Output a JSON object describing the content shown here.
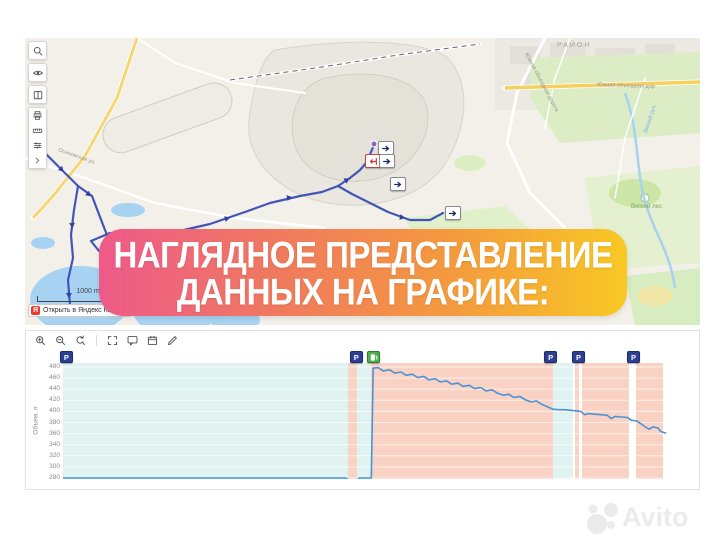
{
  "banner": {
    "line1": "НАГЛЯДНОЕ ПРЕДСТАВЛЕНИЕ",
    "line2": "ДАННЫХ НА ГРАФИКЕ:",
    "gradient": [
      "#ee5a8a",
      "#f0795f",
      "#f49a3e",
      "#f8c824"
    ]
  },
  "map": {
    "scale_label": "1000 m",
    "attribution": "Открыть в Яндекс Картах",
    "attribution_logo_letter": "Я",
    "toolbar_icons": [
      "search",
      "eye",
      "book",
      "print",
      "ruler",
      "tune",
      "chevron-right"
    ],
    "route_color": "#4155b8",
    "labels": [
      {
        "text": "РАЙОН",
        "x": 532,
        "y": 9,
        "size": 7,
        "color": "#a5a39d",
        "rotate": 0,
        "spacing": 2
      },
      {
        "text": "Южная объездная дорога",
        "x": 500,
        "y": 16,
        "size": 5.5,
        "color": "#96948e",
        "rotate": 62,
        "spacing": 0
      },
      {
        "text": "Южная объездная дор",
        "x": 572,
        "y": 48,
        "size": 5.5,
        "color": "#96948e",
        "rotate": 2,
        "spacing": 0
      },
      {
        "text": "Вяский лес",
        "x": 606,
        "y": 170,
        "size": 6,
        "color": "#7aa55a",
        "rotate": 0,
        "spacing": 0
      },
      {
        "text": "Вяский руч.",
        "x": 622,
        "y": 95,
        "size": 5.5,
        "color": "#7fb3de",
        "rotate": -72,
        "spacing": 0
      },
      {
        "text": "Осиновская ул.",
        "x": 33,
        "y": 113,
        "size": 5.5,
        "color": "#9c9a92",
        "rotate": 20,
        "spacing": 0
      }
    ],
    "markers": [
      {
        "x": 353,
        "y": 103,
        "type": "direction"
      },
      {
        "x": 340,
        "y": 116,
        "type": "stop"
      },
      {
        "x": 354,
        "y": 116,
        "type": "direction"
      },
      {
        "x": 365,
        "y": 139,
        "type": "direction"
      },
      {
        "x": 420,
        "y": 168,
        "type": "direction"
      }
    ]
  },
  "chart": {
    "toolbar_icons": [
      "zoom-in",
      "zoom-out",
      "zoom-reset",
      "fullscreen",
      "comment",
      "calendar",
      "edit"
    ],
    "marker_glyphs": {
      "parking": "P"
    }
  },
  "chart_data": {
    "type": "line",
    "title": "",
    "xlabel": "",
    "ylabel": "Объем, л",
    "ylim": [
      280,
      480
    ],
    "yticks": [
      480,
      460,
      440,
      420,
      400,
      380,
      360,
      340,
      320,
      300,
      280
    ],
    "x_unit": "percent of visible time range (no x tick labels shown)",
    "grid": true,
    "legend": false,
    "bands": [
      {
        "from": 0,
        "to": 45.0,
        "kind": "parking",
        "color": "#e1f3f1"
      },
      {
        "from": 45.0,
        "to": 46.4,
        "kind": "movement",
        "color": "#f9d2c4"
      },
      {
        "from": 46.4,
        "to": 48.7,
        "kind": "parking",
        "color": "#e1f3f1"
      },
      {
        "from": 48.7,
        "to": 77.4,
        "kind": "movement",
        "color": "#f9d2c4"
      },
      {
        "from": 77.4,
        "to": 80.6,
        "kind": "parking",
        "color": "#e1f3f1"
      },
      {
        "from": 80.9,
        "to": 81.5,
        "kind": "movement",
        "color": "#f9d2c4"
      },
      {
        "from": 82.0,
        "to": 89.4,
        "kind": "movement",
        "color": "#f9d2c4"
      },
      {
        "from": 90.5,
        "to": 94.8,
        "kind": "movement",
        "color": "#f9d2c4"
      }
    ],
    "markers": [
      {
        "x": 0.3,
        "type": "parking"
      },
      {
        "x": 46.1,
        "type": "parking"
      },
      {
        "x": 48.8,
        "type": "fueling"
      },
      {
        "x": 76.8,
        "type": "parking"
      },
      {
        "x": 81.2,
        "type": "parking"
      },
      {
        "x": 89.9,
        "type": "parking"
      }
    ],
    "series": [
      {
        "name": "Объем топлива, л",
        "color": "#4a93d6",
        "points": [
          [
            0,
            280
          ],
          [
            15,
            280
          ],
          [
            30,
            280
          ],
          [
            44.6,
            280
          ],
          [
            45.2,
            276.5
          ],
          [
            46.4,
            276.5
          ],
          [
            46.9,
            280
          ],
          [
            48.7,
            280
          ],
          [
            49.0,
            478
          ],
          [
            49.8,
            479
          ],
          [
            50.6,
            473
          ],
          [
            51.6,
            475
          ],
          [
            52.4,
            469
          ],
          [
            53.4,
            471
          ],
          [
            54.2,
            465
          ],
          [
            55.2,
            467
          ],
          [
            56.0,
            461
          ],
          [
            57.0,
            463
          ],
          [
            57.8,
            457
          ],
          [
            58.8,
            459
          ],
          [
            59.6,
            453
          ],
          [
            60.6,
            455
          ],
          [
            61.4,
            449
          ],
          [
            62.4,
            451
          ],
          [
            63.2,
            445
          ],
          [
            64.2,
            447
          ],
          [
            65.0,
            441
          ],
          [
            66.0,
            443
          ],
          [
            66.8,
            437
          ],
          [
            67.8,
            439
          ],
          [
            68.6,
            433
          ],
          [
            69.6,
            429
          ],
          [
            70.4,
            431
          ],
          [
            71.2,
            425
          ],
          [
            72.2,
            427
          ],
          [
            73.0,
            421
          ],
          [
            74.0,
            417
          ],
          [
            74.8,
            419
          ],
          [
            75.6,
            413
          ],
          [
            76.6,
            408
          ],
          [
            77.4,
            404
          ],
          [
            78.2,
            403
          ],
          [
            79.2,
            403
          ],
          [
            80.2,
            402
          ],
          [
            81.0,
            401
          ],
          [
            81.8,
            400
          ],
          [
            82.4,
            394
          ],
          [
            83.0,
            396
          ],
          [
            84.0,
            395
          ],
          [
            85.0,
            394
          ],
          [
            86.0,
            393
          ],
          [
            86.6,
            387
          ],
          [
            87.2,
            391
          ],
          [
            88.2,
            390
          ],
          [
            89.2,
            389
          ],
          [
            89.8,
            384
          ],
          [
            90.6,
            383
          ],
          [
            91.4,
            377
          ],
          [
            92.0,
            372
          ],
          [
            92.6,
            368
          ],
          [
            93.2,
            372
          ],
          [
            94.0,
            370
          ],
          [
            94.4,
            364
          ],
          [
            94.9,
            362
          ],
          [
            95.2,
            361
          ]
        ]
      }
    ]
  },
  "watermark": {
    "text": "Avito"
  }
}
